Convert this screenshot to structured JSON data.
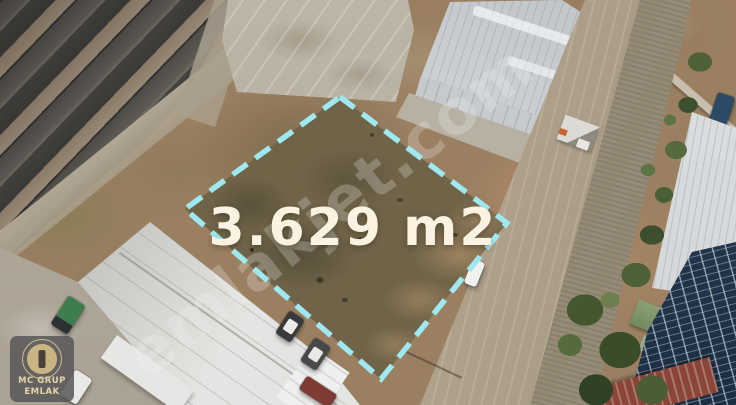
{
  "scene": {
    "description": "Aerial drone photo of a vacant industrial land plot for sale, outlined with a dashed cyan boundary, surrounded by old warehouses, modern white warehouses, an access road, a drainage canal with trees and rooftop solar panels",
    "area_label": "3.629 m2",
    "watermark": "emlakjet.com",
    "logo": {
      "line1": "MC GRUP",
      "line2": "EMLAK"
    },
    "colors": {
      "boundary_dash": "#9fe8f0",
      "area_label_text": "#fbf2e2",
      "dirt_ground": "#9a7f61",
      "plot_interior": "#6f6348"
    }
  }
}
